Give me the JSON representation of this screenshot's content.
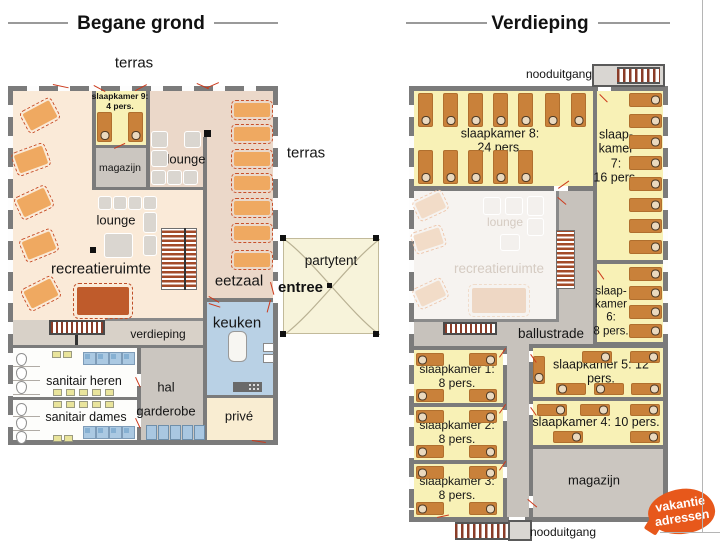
{
  "ground_floor": {
    "title": "Begane grond",
    "terras_top": "terras",
    "terras_right": "terras",
    "rooms": {
      "slaapkamer9": "slaapkamer 9:\n4 pers.",
      "magazijn": "magazijn",
      "lounge_upper": "lounge",
      "lounge_lower": "lounge",
      "recreatieruimte": "recreatieruimte",
      "eetzaal": "eetzaal",
      "verdieping": "verdieping",
      "keuken": "keuken",
      "hal": "hal",
      "garderobe": "garderobe",
      "prive": "privé",
      "sanitair_heren": "sanitair heren",
      "sanitair_dames": "sanitair dames"
    },
    "partytent": "partytent",
    "entree": "entree"
  },
  "upper_floor": {
    "title": "Verdieping",
    "nooduitgang_top": "nooduitgang",
    "nooduitgang_bottom": "nooduitgang",
    "rooms": {
      "slaapkamer8": "slaapkamer 8:\n24 pers.",
      "slaapkamer7": "slaap-\nkamer\n7:\n16 pers.",
      "slaapkamer6": "slaap-\nkamer\n6:\n8 pers.",
      "slaapkamer1": "slaapkamer 1:\n8 pers.",
      "slaapkamer2": "slaapkamer 2:\n8 pers.",
      "slaapkamer3": "slaapkamer 3:\n8 pers.",
      "slaapkamer5": "slaapkamer 5: 12 pers.",
      "slaapkamer4": "slaapkamer 4: 10 pers.",
      "magazijn": "magazijn",
      "lounge_faded": "lounge",
      "recreatieruimte_faded": "recreatieruimte",
      "ballustrade": "ballustrade"
    }
  },
  "logo": {
    "line1": "vakantie",
    "line2": "adressen"
  },
  "colors": {
    "wall": "#7b7b7b",
    "bedroom_yellow": "#f8f1b6",
    "bed_orange": "#c9813a",
    "floor_cream": "#faead8",
    "floor_pink": "#ebd8c9",
    "kitchen_blue": "#b9d1e5",
    "door_red": "#cc3a1c",
    "logo_orange": "#e7581b"
  }
}
